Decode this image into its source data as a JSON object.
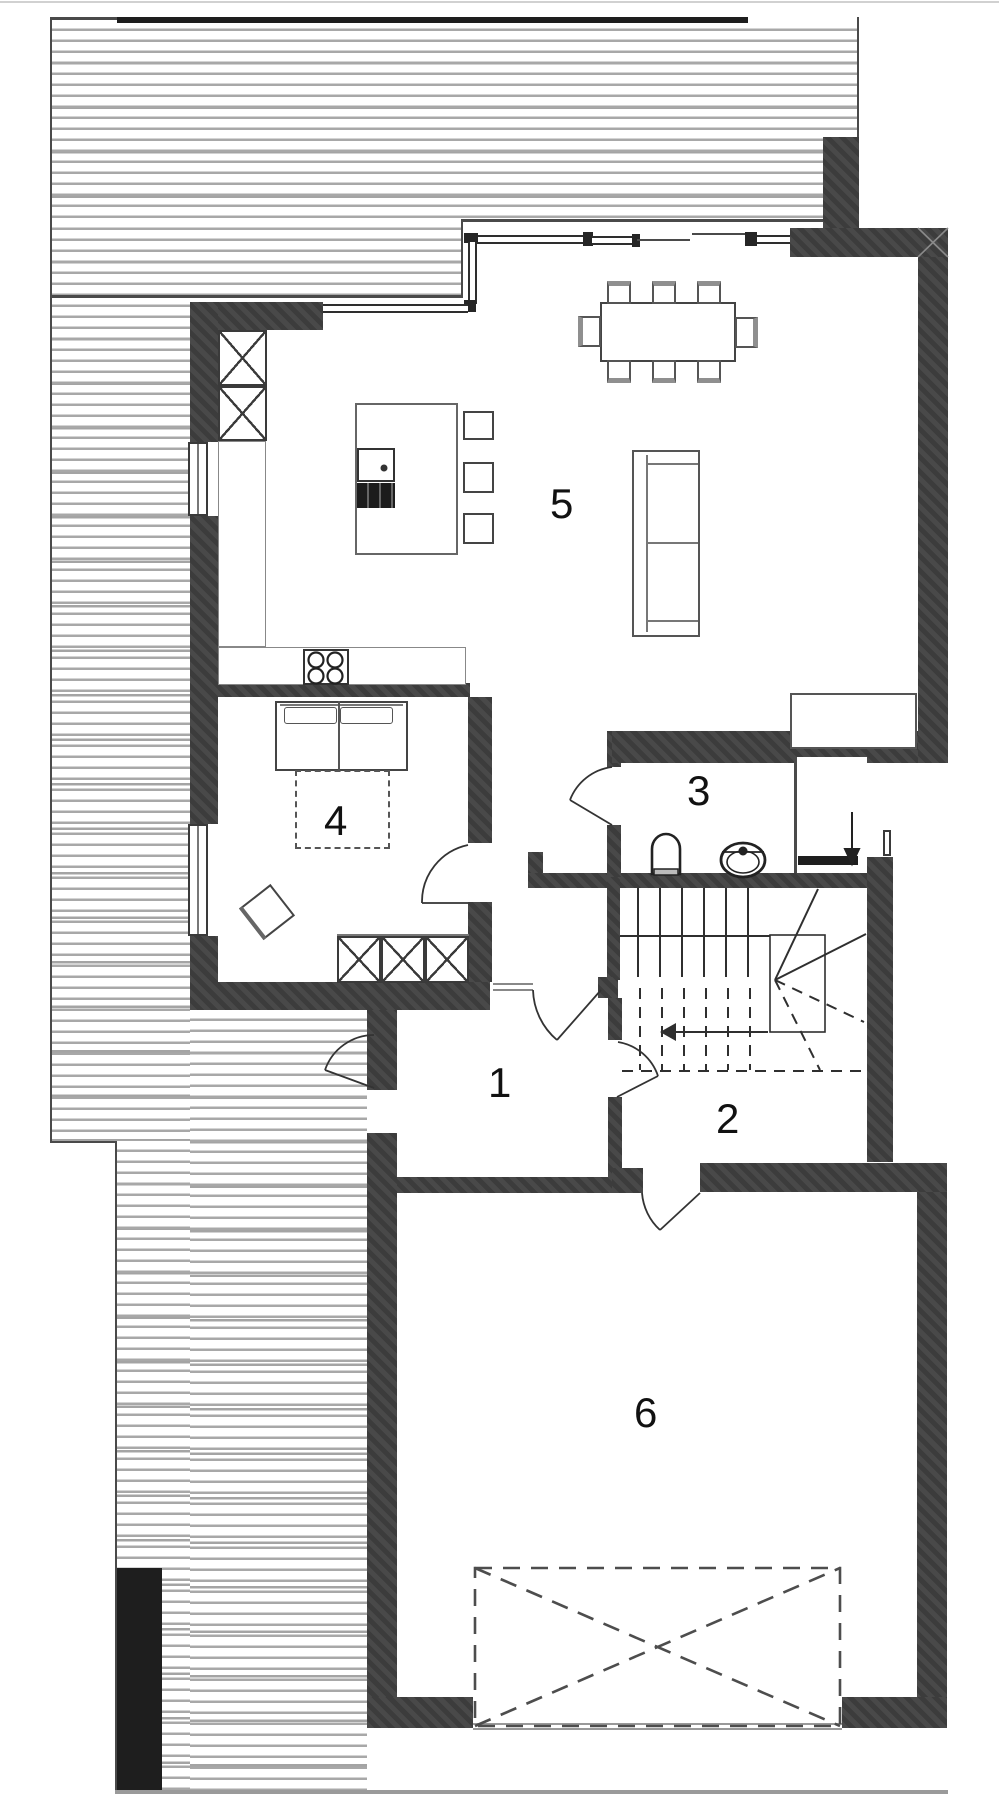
{
  "drawing": {
    "kind": "floor-plan",
    "room_labels": [
      {
        "label": "1"
      },
      {
        "label": "2"
      },
      {
        "label": "3"
      },
      {
        "label": "4"
      },
      {
        "label": "5"
      },
      {
        "label": "6"
      }
    ],
    "fixtures": [
      "dining-table-with-8-chairs",
      "sofa",
      "kitchen-island-with-sink-and-hob",
      "bar-stools",
      "tall-cabinets",
      "cooktop-4-burners",
      "wardrobe",
      "double-bed",
      "pouf",
      "toilet",
      "washbasin",
      "fireplace",
      "winder-staircase",
      "garage-gate",
      "entrance-arrow"
    ],
    "colors": {
      "wall": "#3f3f3f",
      "outline": "#4a4a4a",
      "hatch_line": "#a8a8a8",
      "furniture_line": "#555555",
      "label": "#111111",
      "accent_dark": "#1e1e1e",
      "background": "#ffffff"
    }
  }
}
